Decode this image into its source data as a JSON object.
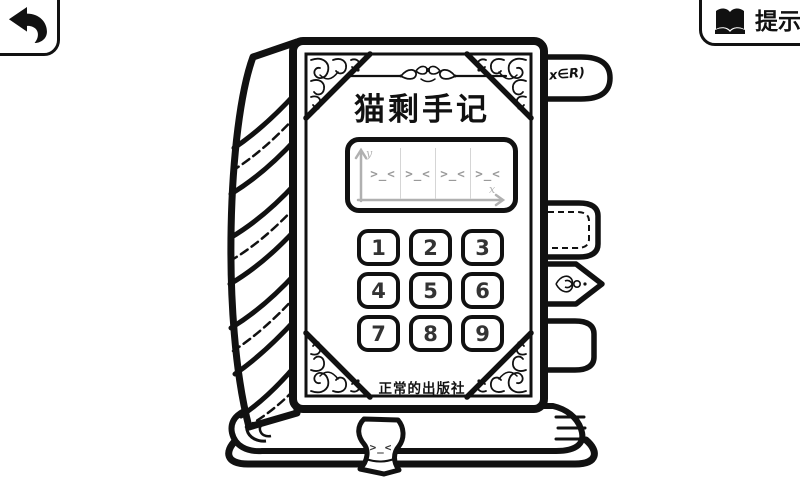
{
  "nav": {
    "back": {
      "icon": "return-arrow"
    },
    "hint": {
      "label": "提示",
      "icon": "open-book"
    }
  },
  "book": {
    "title": "猫剩手记",
    "publisher": "正常的出版社",
    "bookmark_label": "x∈R)",
    "display": {
      "y_axis_label": "y",
      "x_axis_label": "x",
      "slots": [
        ">_<",
        ">_<",
        ">_<",
        ">_<"
      ]
    },
    "keypad": {
      "keys": [
        "1",
        "2",
        "3",
        "4",
        "5",
        "6",
        "7",
        "8",
        "9"
      ]
    },
    "ribbon_face": ">_<"
  },
  "colors": {
    "ink": "#111111",
    "background": "#ffffff",
    "panel_muted": "#b0b0b0",
    "face_gray": "#9a9a9a",
    "key_text": "#333333"
  }
}
